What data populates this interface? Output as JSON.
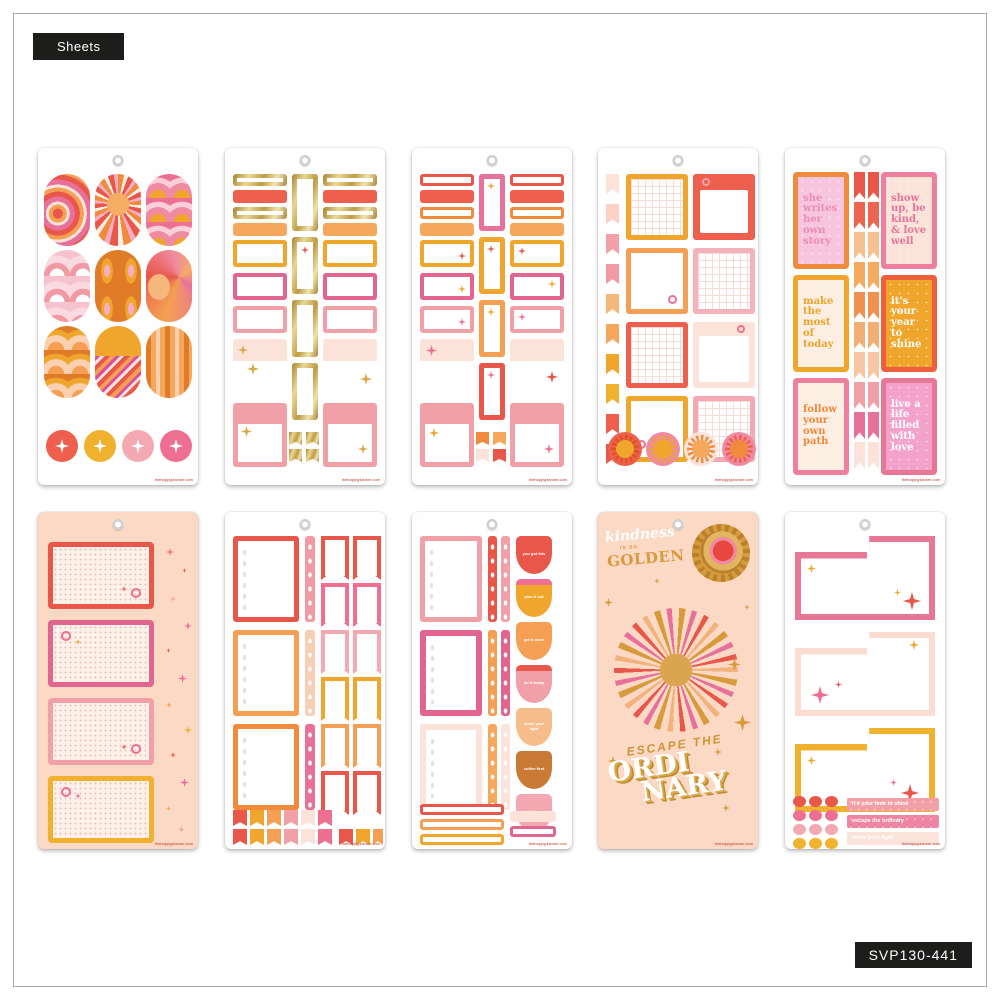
{
  "page": {
    "tab_label": "Sheets",
    "product_code": "SVP130-441",
    "watermark": "thehappyplanner.com"
  },
  "palette": {
    "red": "#e8574a",
    "coral": "#ee5f4e",
    "tangerine": "#f08b3e",
    "orange": "#f49f53",
    "yellow": "#f0a62d",
    "gold_foil": "#cda24c",
    "pink": "#e26590",
    "rose": "#ef6f92",
    "light_pink": "#f2a0a8",
    "blush": "#fbe3da",
    "peach_sheet": "#fcd9c4",
    "label_black": "#1d1d1b"
  },
  "sheet5_quotes": {
    "q1": "she writes her own story",
    "q2": "show up, be kind, & love well",
    "q3": "make the most of today",
    "q4": "it's your year to shine",
    "q5": "follow your own path",
    "q6": "live a life filled with love"
  },
  "sheet8_badges": [
    "you got this",
    "plan it out",
    "get it done",
    "do it today",
    "shine your light",
    "coffee first",
    "don't forget"
  ],
  "sheet9": {
    "script_word": "kindness",
    "small_words": "is so",
    "big_word": "GOLDEN",
    "escape": "ESCAPE THE",
    "ordinary_top": "ORDI",
    "ordinary_bottom": "NARY"
  },
  "sheet10_bars": [
    "it's your time to shine",
    "escape the ordinary",
    "shine your light"
  ]
}
